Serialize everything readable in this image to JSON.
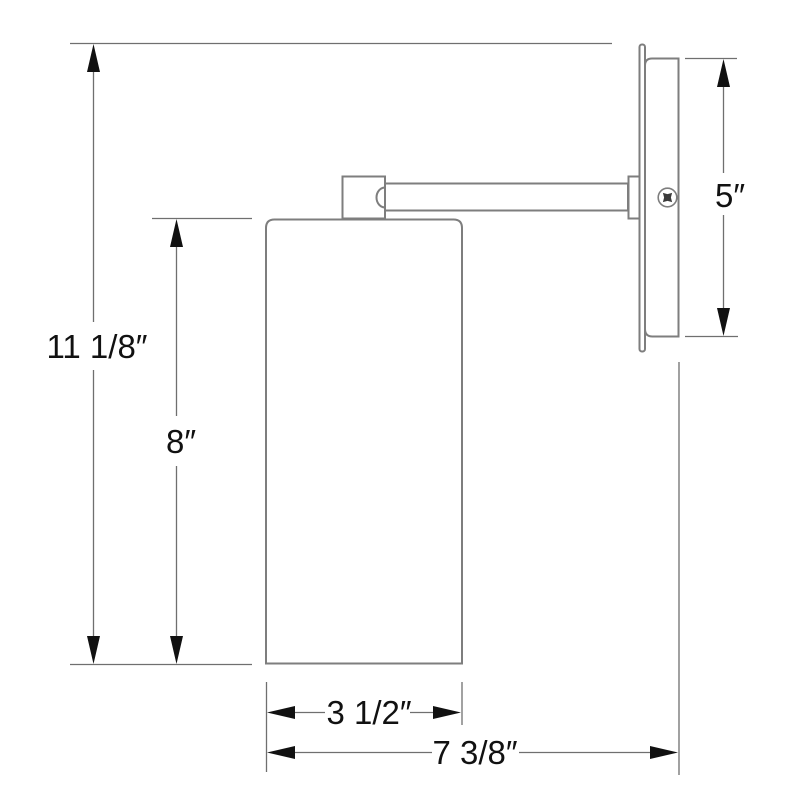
{
  "diagram": {
    "type": "technical-dimension-drawing",
    "subject": "wall sconce side elevation with dimensions",
    "labels": {
      "overall_height": "11 1/8″",
      "shade_height": "8″",
      "backplate_height": "5″",
      "shade_width": "3 1/2″",
      "overall_depth": "7 3/8″"
    },
    "icons": {
      "screw": "phillips-screw-head in circle"
    },
    "colors": {
      "outline": "#7e7e7e",
      "dimension_line": "#6f6f6f",
      "arrow_and_text": "#111111",
      "background": "#ffffff"
    }
  }
}
